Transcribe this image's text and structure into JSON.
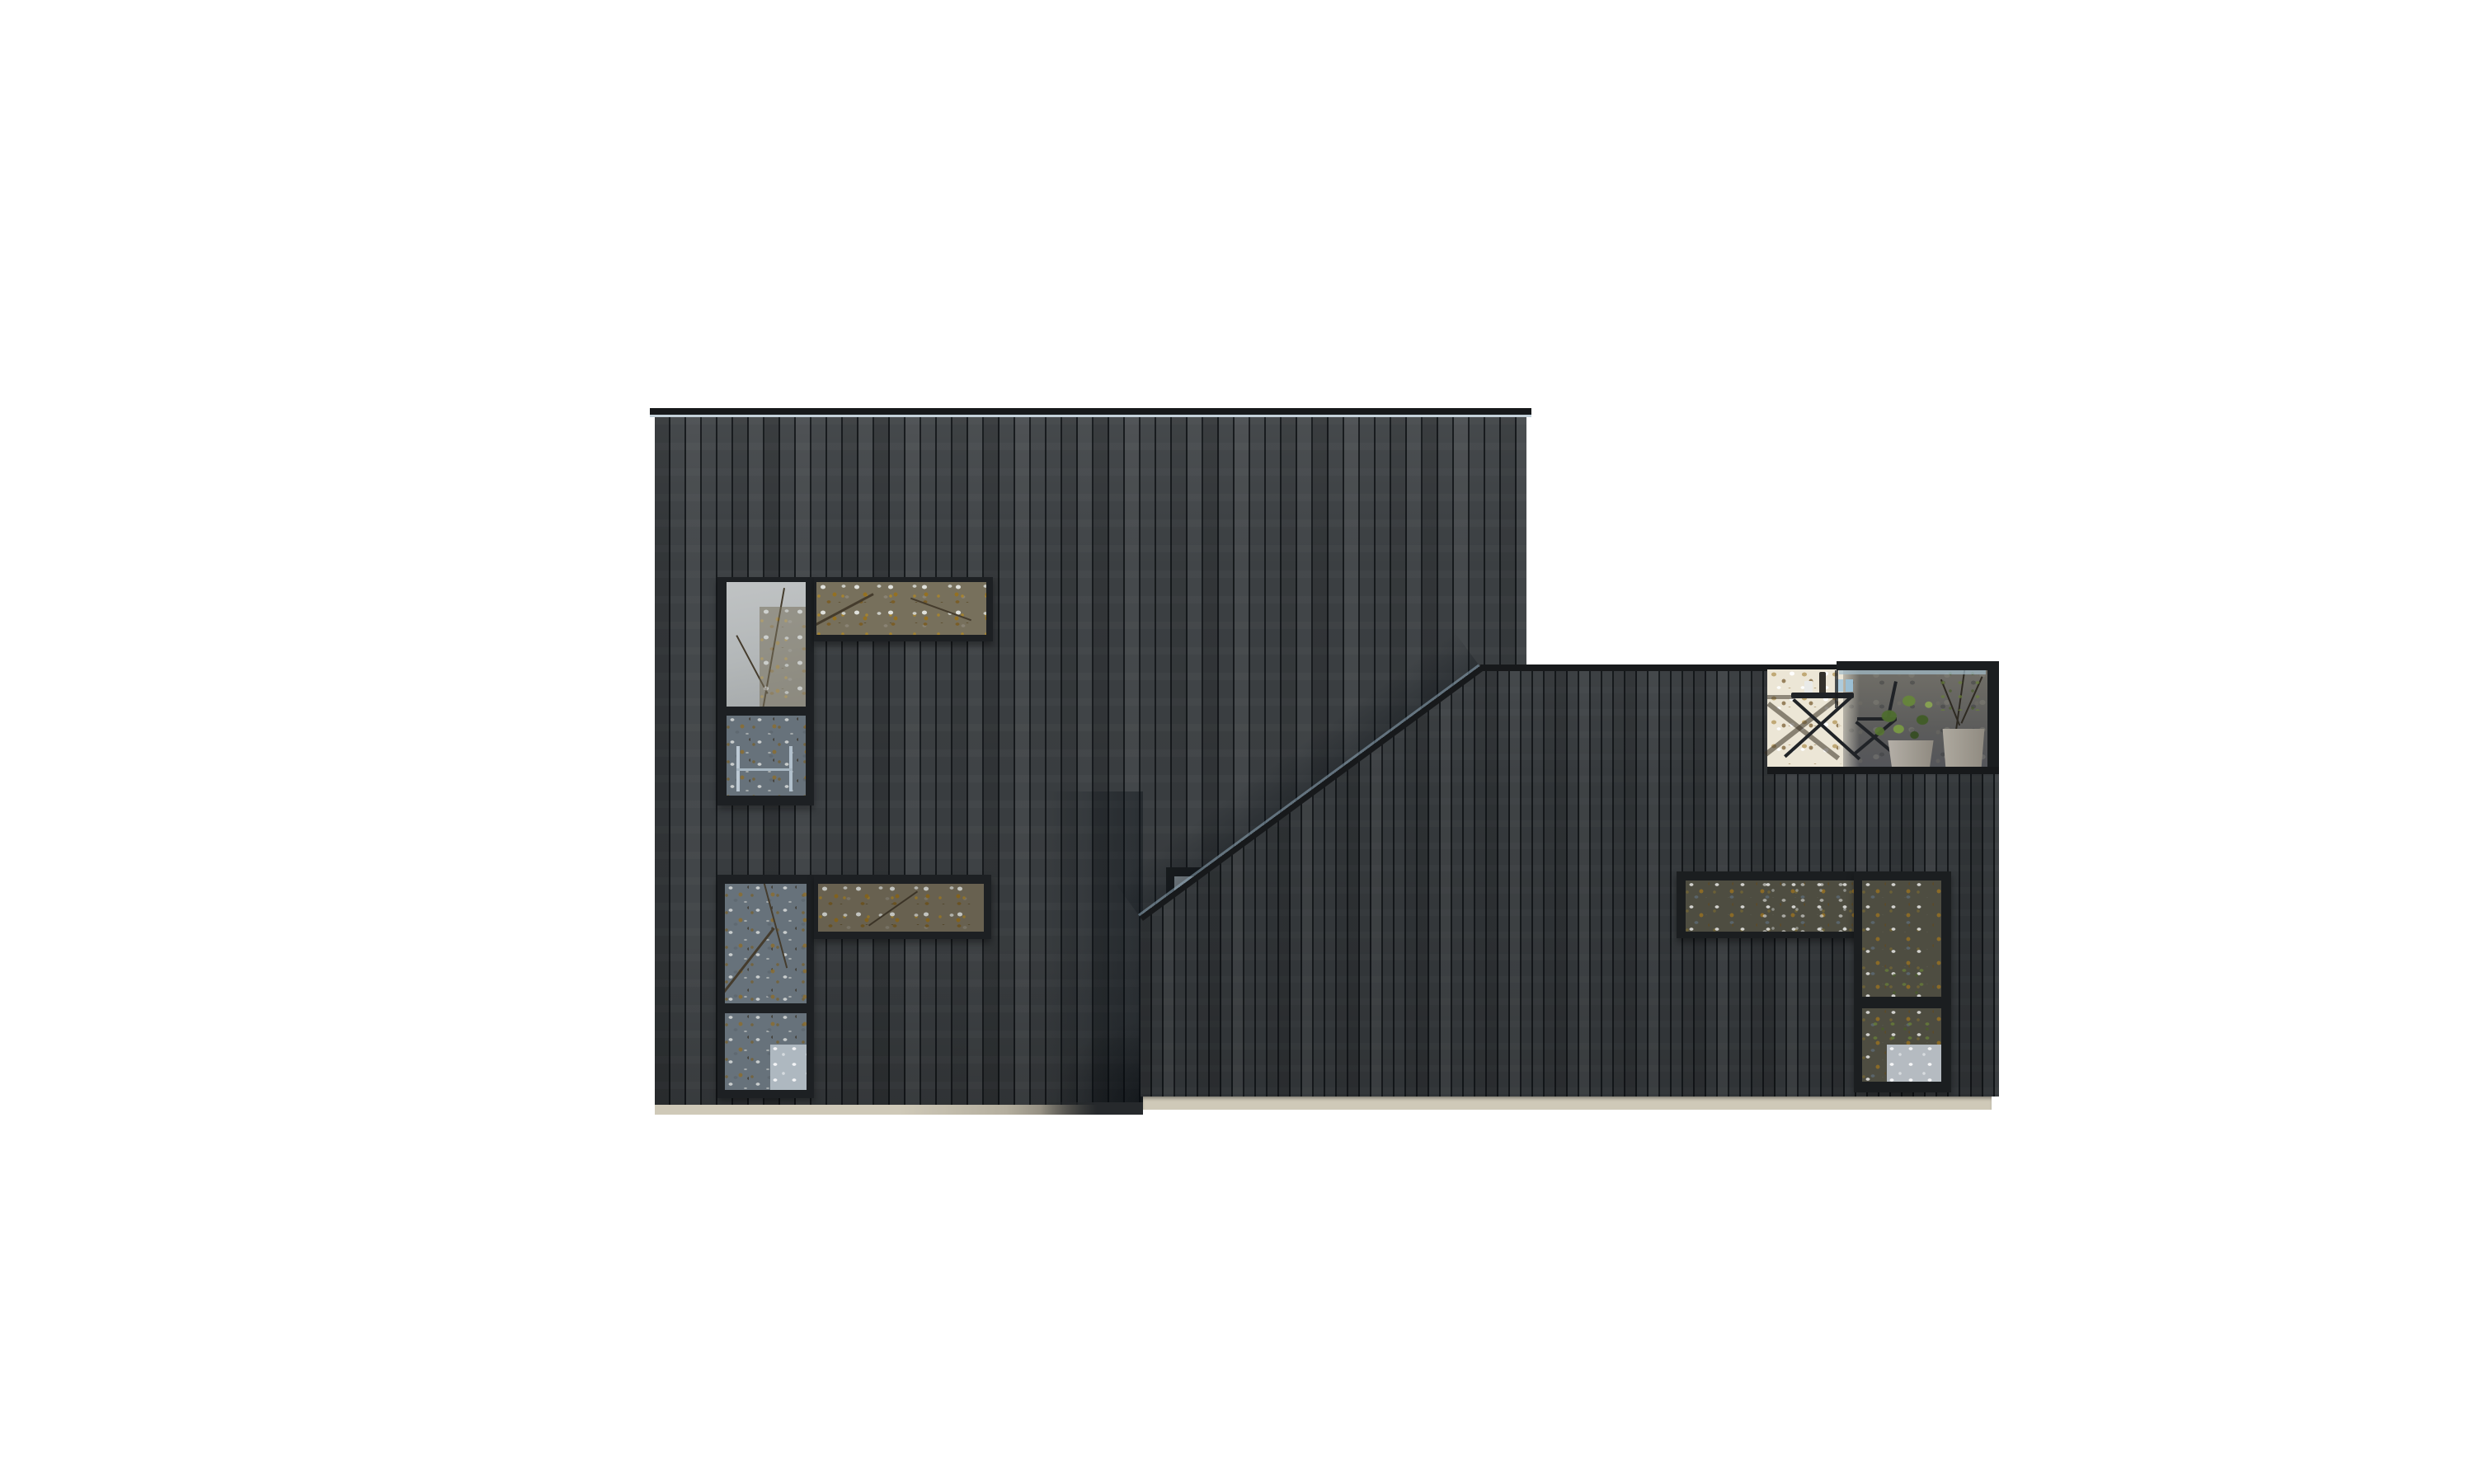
{
  "scene": {
    "description": "Side elevation render of a modern house: a tall two-storey volume and a lower volume joined by a sloped roof edge, both clad in dark charred vertical timber boards on a light plinth, with corner window bands reflecting autumn trees and a recessed rooftop terrace holding bistro furniture and potted plants.",
    "background": "#ffffff"
  },
  "palette": {
    "page-bg": "#ffffff",
    "cladding-main": "#3b3f42",
    "cladding-low": "#35393c",
    "roof-flashing": "#17191b",
    "flashing-glint": "#90a9ba",
    "window-frame": "#1d2023",
    "window-frame-low": "#1b1e20",
    "sky-reflection": "#b7bbbc",
    "glass-slate": "#67727b",
    "glass-olive": "#4e4d41",
    "foliage-ochre": "#8f6d28",
    "foliage-brown": "#5c4a28",
    "plant-green": "#577a2e",
    "terrace-bright": "#ece6d6",
    "terrace-shade": "#626260",
    "pot-light": "#b3aea6",
    "pot-beige": "#a7a298",
    "railing-glass-glint": "#a2bccb",
    "plinth": "#cfc9b8",
    "plinth-shadow": "#6e6a60",
    "cast-shadow": "#0a1016"
  },
  "building": {
    "blocks": [
      {
        "name": "main-block",
        "storeys": 2,
        "roof": "flat parapet with dark flashing"
      },
      {
        "name": "low-block",
        "storeys": 1,
        "roof": "flat parapet with sloped flashing link"
      }
    ],
    "windows": [
      {
        "name": "upper-left-corner-window",
        "panes": [
          "tall sky pane",
          "clerestory foliage strip"
        ]
      },
      {
        "name": "lower-left-corner-window",
        "panes": [
          "tall slate pane",
          "clerestory foliage strip"
        ]
      },
      {
        "name": "stair-slot-window",
        "note": "small window partly hidden behind sloped flashing"
      },
      {
        "name": "right-corner-window",
        "panes": [
          "clerestory foliage strip",
          "tall pane with bright lower reflection"
        ]
      }
    ],
    "terrace": {
      "name": "rooftop-terrace",
      "features": [
        "glass balustrade with handrail",
        "folding bistro table",
        "folding chairs",
        "leafy plant in light grey pot",
        "twiggy plant in beige pot"
      ]
    }
  }
}
